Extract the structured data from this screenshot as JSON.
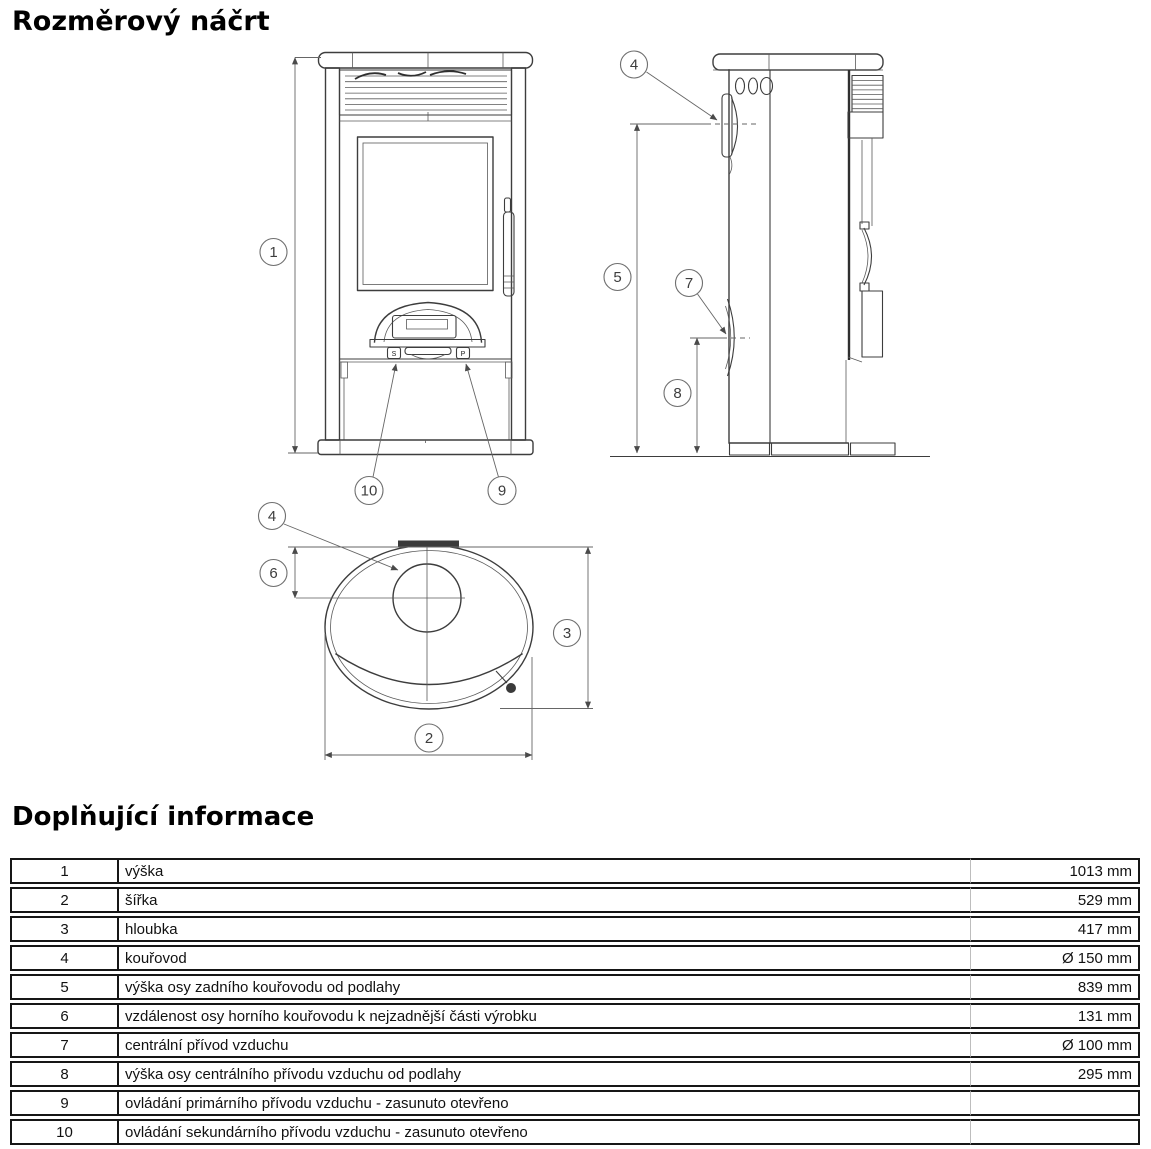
{
  "page": {
    "title1": "Rozměrový náčrt",
    "title2": "Doplňující informace"
  },
  "drawing": {
    "callouts": {
      "c1": "1",
      "c2": "2",
      "c3": "3",
      "c4": "4",
      "c5": "5",
      "c6": "6",
      "c7": "7",
      "c8": "8",
      "c9": "9",
      "c10": "10"
    },
    "front": {
      "secondary_tab": "S",
      "primary_tab": "P"
    }
  },
  "table": {
    "rows": [
      {
        "num": "1",
        "desc": "výška",
        "value": "1013 mm"
      },
      {
        "num": "2",
        "desc": "šířka",
        "value": "529 mm"
      },
      {
        "num": "3",
        "desc": "hloubka",
        "value": "417 mm"
      },
      {
        "num": "4",
        "desc": "kouřovod",
        "value": "Ø 150 mm"
      },
      {
        "num": "5",
        "desc": "výška osy zadního kouřovodu od podlahy",
        "value": "839 mm"
      },
      {
        "num": "6",
        "desc": "vzdálenost osy horního kouřovodu k nejzadnější části výrobku",
        "value": "131 mm"
      },
      {
        "num": "7",
        "desc": "centrální přívod vzduchu",
        "value": "Ø 100 mm"
      },
      {
        "num": "8",
        "desc": "výška osy centrálního přívodu vzduchu od podlahy",
        "value": "295 mm"
      },
      {
        "num": "9",
        "desc": "ovládání primárního přívodu vzduchu - zasunuto otevřeno",
        "value": ""
      },
      {
        "num": "10",
        "desc": "ovládání sekundárního přívodu vzduchu - zasunuto otevřeno",
        "value": ""
      }
    ]
  }
}
